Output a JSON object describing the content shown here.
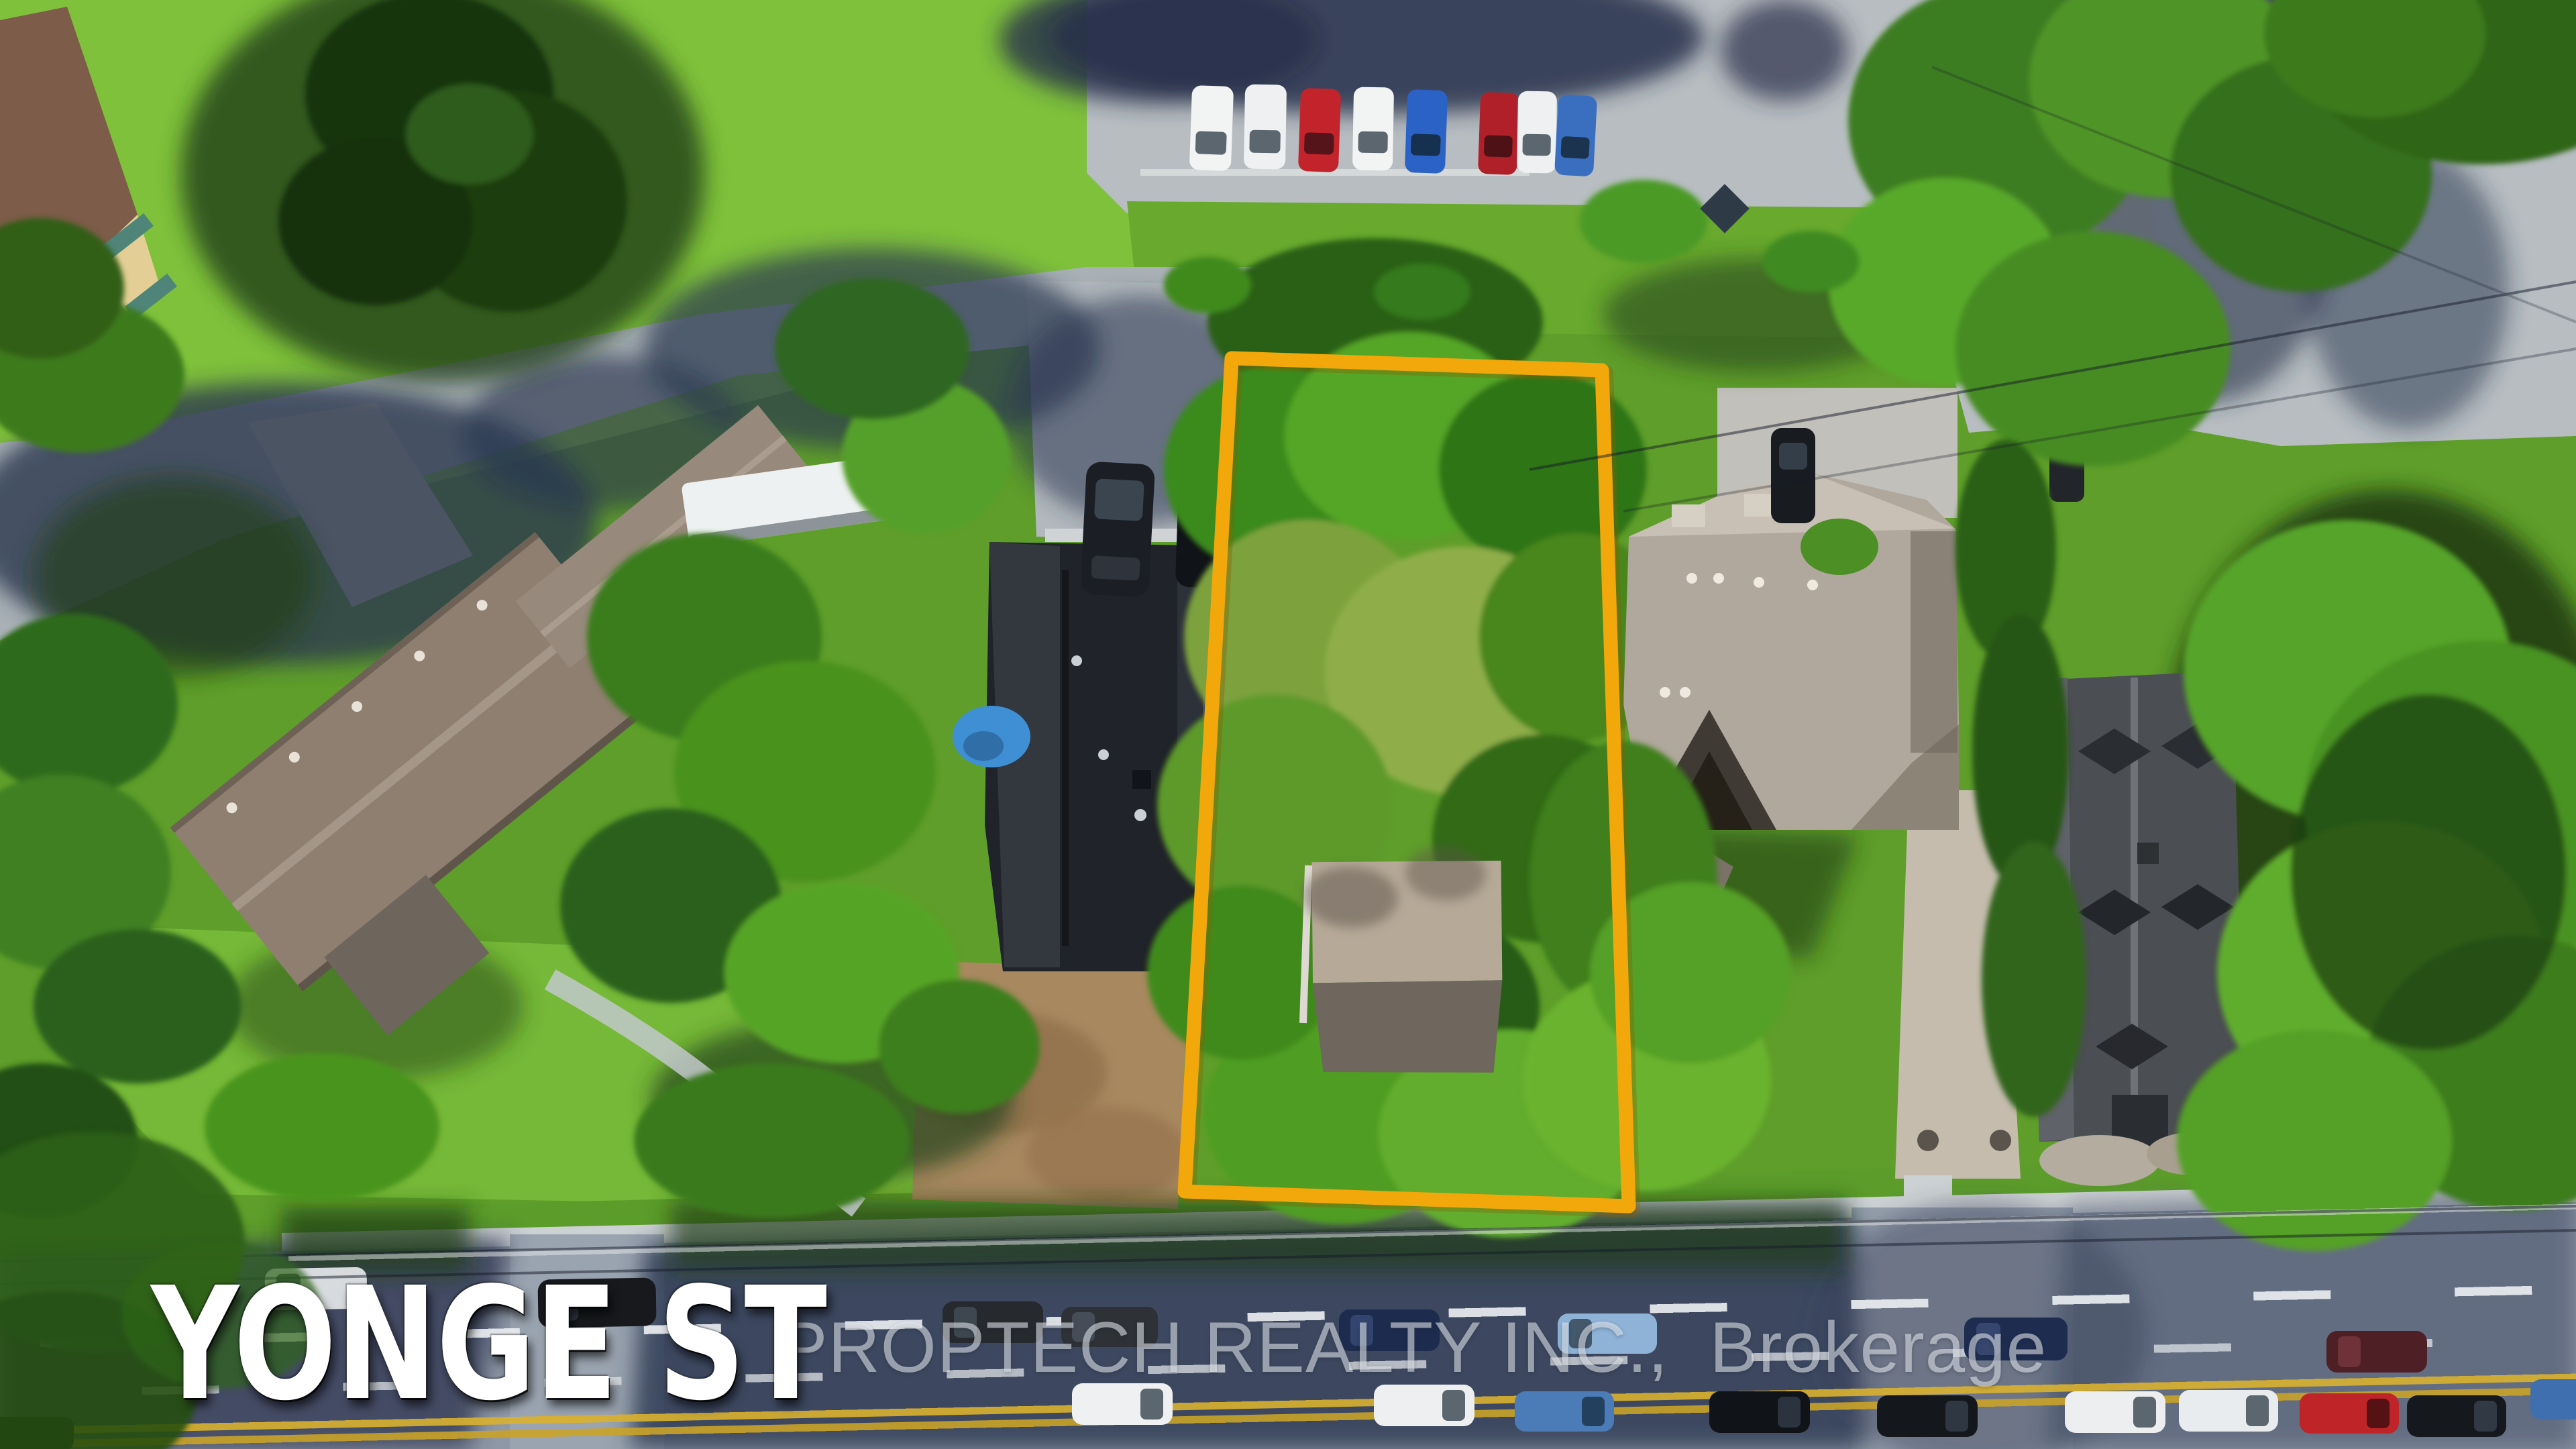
{
  "overlays": {
    "street_label": "YONGE ST",
    "watermark": "PROPTECH REALTY INC.,  Brokerage"
  },
  "scene": {
    "type": "aerial-drone-photo",
    "highlight": "property-lot-outline",
    "lot_outline_corners": [
      [
        1836,
        534
      ],
      [
        2388,
        552
      ],
      [
        2428,
        1798
      ],
      [
        1766,
        1776
      ]
    ]
  },
  "colors": {
    "lot_outline": "#F2A70A",
    "street_label_text": "#FFFFFF",
    "watermark_text": "rgba(238,243,248,0.55)",
    "grass_bright": "#7FC13B",
    "grass_base": "#5F9E2A",
    "pavement": "#B7BDC1",
    "road_shadow": "#2C3650",
    "roof_left_house": "#8F7F70",
    "roof_center_house": "#202329",
    "roof_right_house": "#B0A89C",
    "roof_far_right_house": "#4B4E53",
    "lane_yellow": "#D9B02E"
  }
}
